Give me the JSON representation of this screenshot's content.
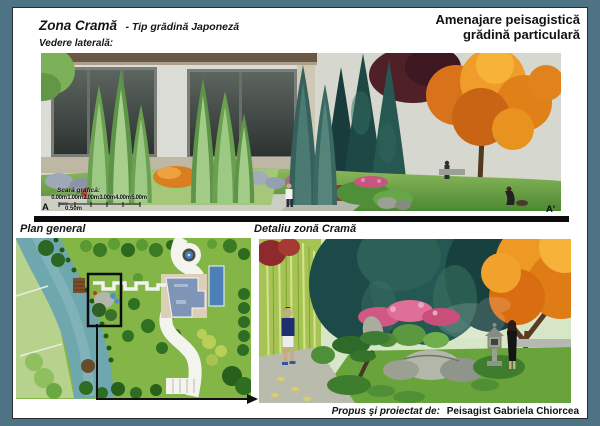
{
  "header": {
    "title_main": "Zona Cramă",
    "title_sub": "- Tip grădină Japoneză",
    "view_label": "Vedere laterală:",
    "project_title_line1": "Amenajare peisagistică",
    "project_title_line2": "grădină particulară"
  },
  "side_view": {
    "section_start": "A",
    "section_end": "A'",
    "scalebar": {
      "label": "Scară grafică:",
      "ticks": [
        "0.00m",
        "1.00m",
        "2.00m",
        "3.00m",
        "4.00m",
        "5.00m"
      ],
      "sub_tick": "0.50m"
    }
  },
  "plan": {
    "label": "Plan general"
  },
  "detail": {
    "label": "Detaliu zonă Cramă"
  },
  "footer": {
    "credit_label": "Propus şi proiectat de:",
    "credit_name": "Peisagist Gabriela Chiorcea"
  },
  "palette": {
    "frame": "#4e7384",
    "page": "#ffffff",
    "section_bar": "#0b0b0b",
    "lawn_green": "#76ad4a",
    "conifer_light": "#8fbf74",
    "spruce_teal": "#24504b",
    "blue_spruce": "#47776d",
    "autumn_orange": "#e8881e",
    "maroon_tree": "#54222c",
    "azalea_pink": "#d15884",
    "lake_teal": "#6fa7ae",
    "plan_lawn": "#83b646",
    "path_grey": "#b9bbac",
    "house_wall": "#dcdcd6",
    "plan_house": "#7e95b7",
    "pool_blue": "#4e80b8"
  }
}
